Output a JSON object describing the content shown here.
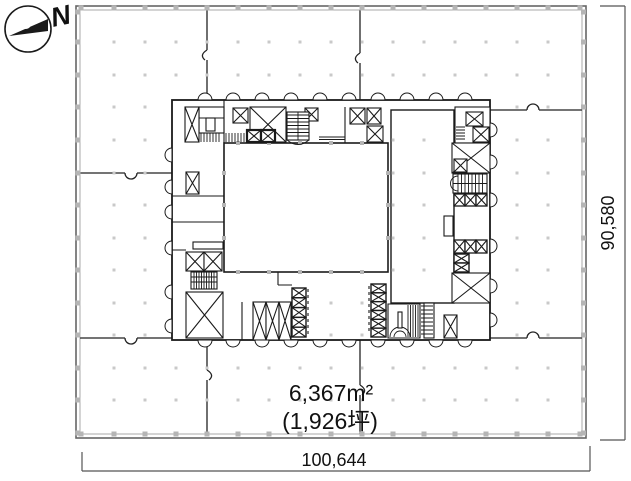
{
  "north": {
    "label": "N"
  },
  "dimensions": {
    "width_label": "100,644",
    "height_label": "90,580"
  },
  "area": {
    "primary": "6,367m²",
    "secondary": "(1,926坪)"
  },
  "icons": {
    "north_arrow": "compass-north-arrow",
    "shaft_symbol": "crossed-box-shaft",
    "stair_symbol": "stair-run"
  },
  "colors": {
    "line": "#1a1a1a",
    "partition": "#222222",
    "wall_outer": "#666666",
    "wall_inner": "#a8a8a8",
    "dimension": "#555555",
    "dot": "#c9c9c9",
    "column_marker": "#b5b5b5",
    "background": "#ffffff"
  }
}
